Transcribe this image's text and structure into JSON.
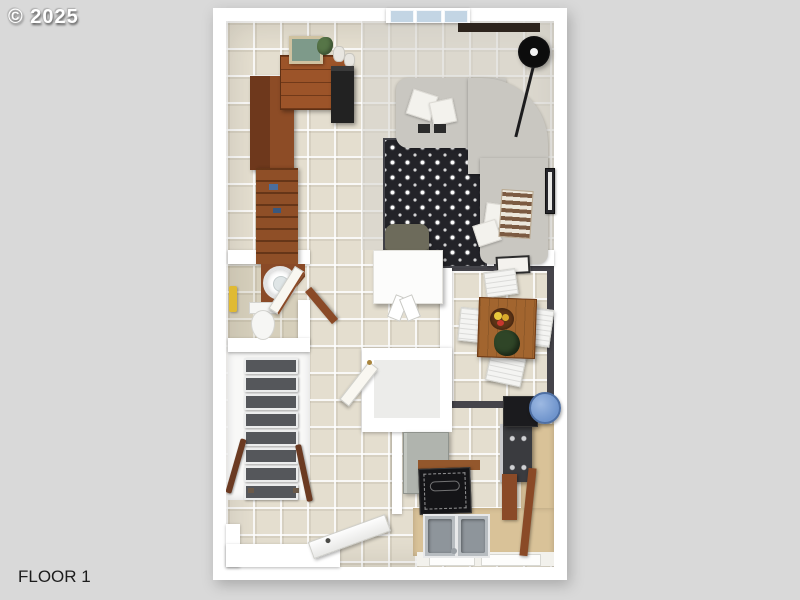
{
  "watermark": "© 2025",
  "floor_label": "FLOOR 1",
  "scene": {
    "type": "3d-floorplan-render",
    "rooms": [
      "living-room",
      "office-nook",
      "dining-area",
      "kitchen",
      "bathroom",
      "staircase",
      "entry-hall",
      "closet"
    ],
    "furniture": [
      "sectional-sofa",
      "patterned-rug",
      "floor-lamp",
      "dresser",
      "wall-art",
      "bookshelf",
      "wardrobe",
      "desk",
      "desk-chair",
      "dining-table",
      "dining-chairs",
      "fruit-bowl",
      "centerpiece-plant",
      "corner-sink-vanity",
      "toilet",
      "stair-treads",
      "handrails",
      "refrigerator",
      "stove",
      "microwave",
      "kitchen-sink",
      "kitchen-mat",
      "entry-door"
    ]
  },
  "colors": {
    "background": "#d9d9d9",
    "wall_white": "#ffffff",
    "tile_floor": "#e4decf",
    "wood_dark": "#6e381c",
    "wood_mid": "#8d4c26",
    "wood_table": "#a2652f",
    "sofa_gray": "#c9c7c1",
    "cushion_white": "#f3f2ed",
    "rug_black": "#232328",
    "rug_motif": "#ffffff",
    "stair_tread": "#55575b",
    "window_glass": "#c3d5e4",
    "lamp_black": "#161618",
    "chair_olive": "#6d6b5b",
    "dining_border": "#45444a",
    "counter_tan": "#d9c298",
    "sink_steel": "#b7bcc0",
    "mat_black": "#141417",
    "bowl_blue": "#7fa2d6",
    "towel_yellow": "#e0ba33",
    "fruit_yellow": "#e8c93c",
    "plant_green": "#3d5233",
    "fridge_gray": "#b0b4ae",
    "label_text": "#1c1c1c"
  }
}
